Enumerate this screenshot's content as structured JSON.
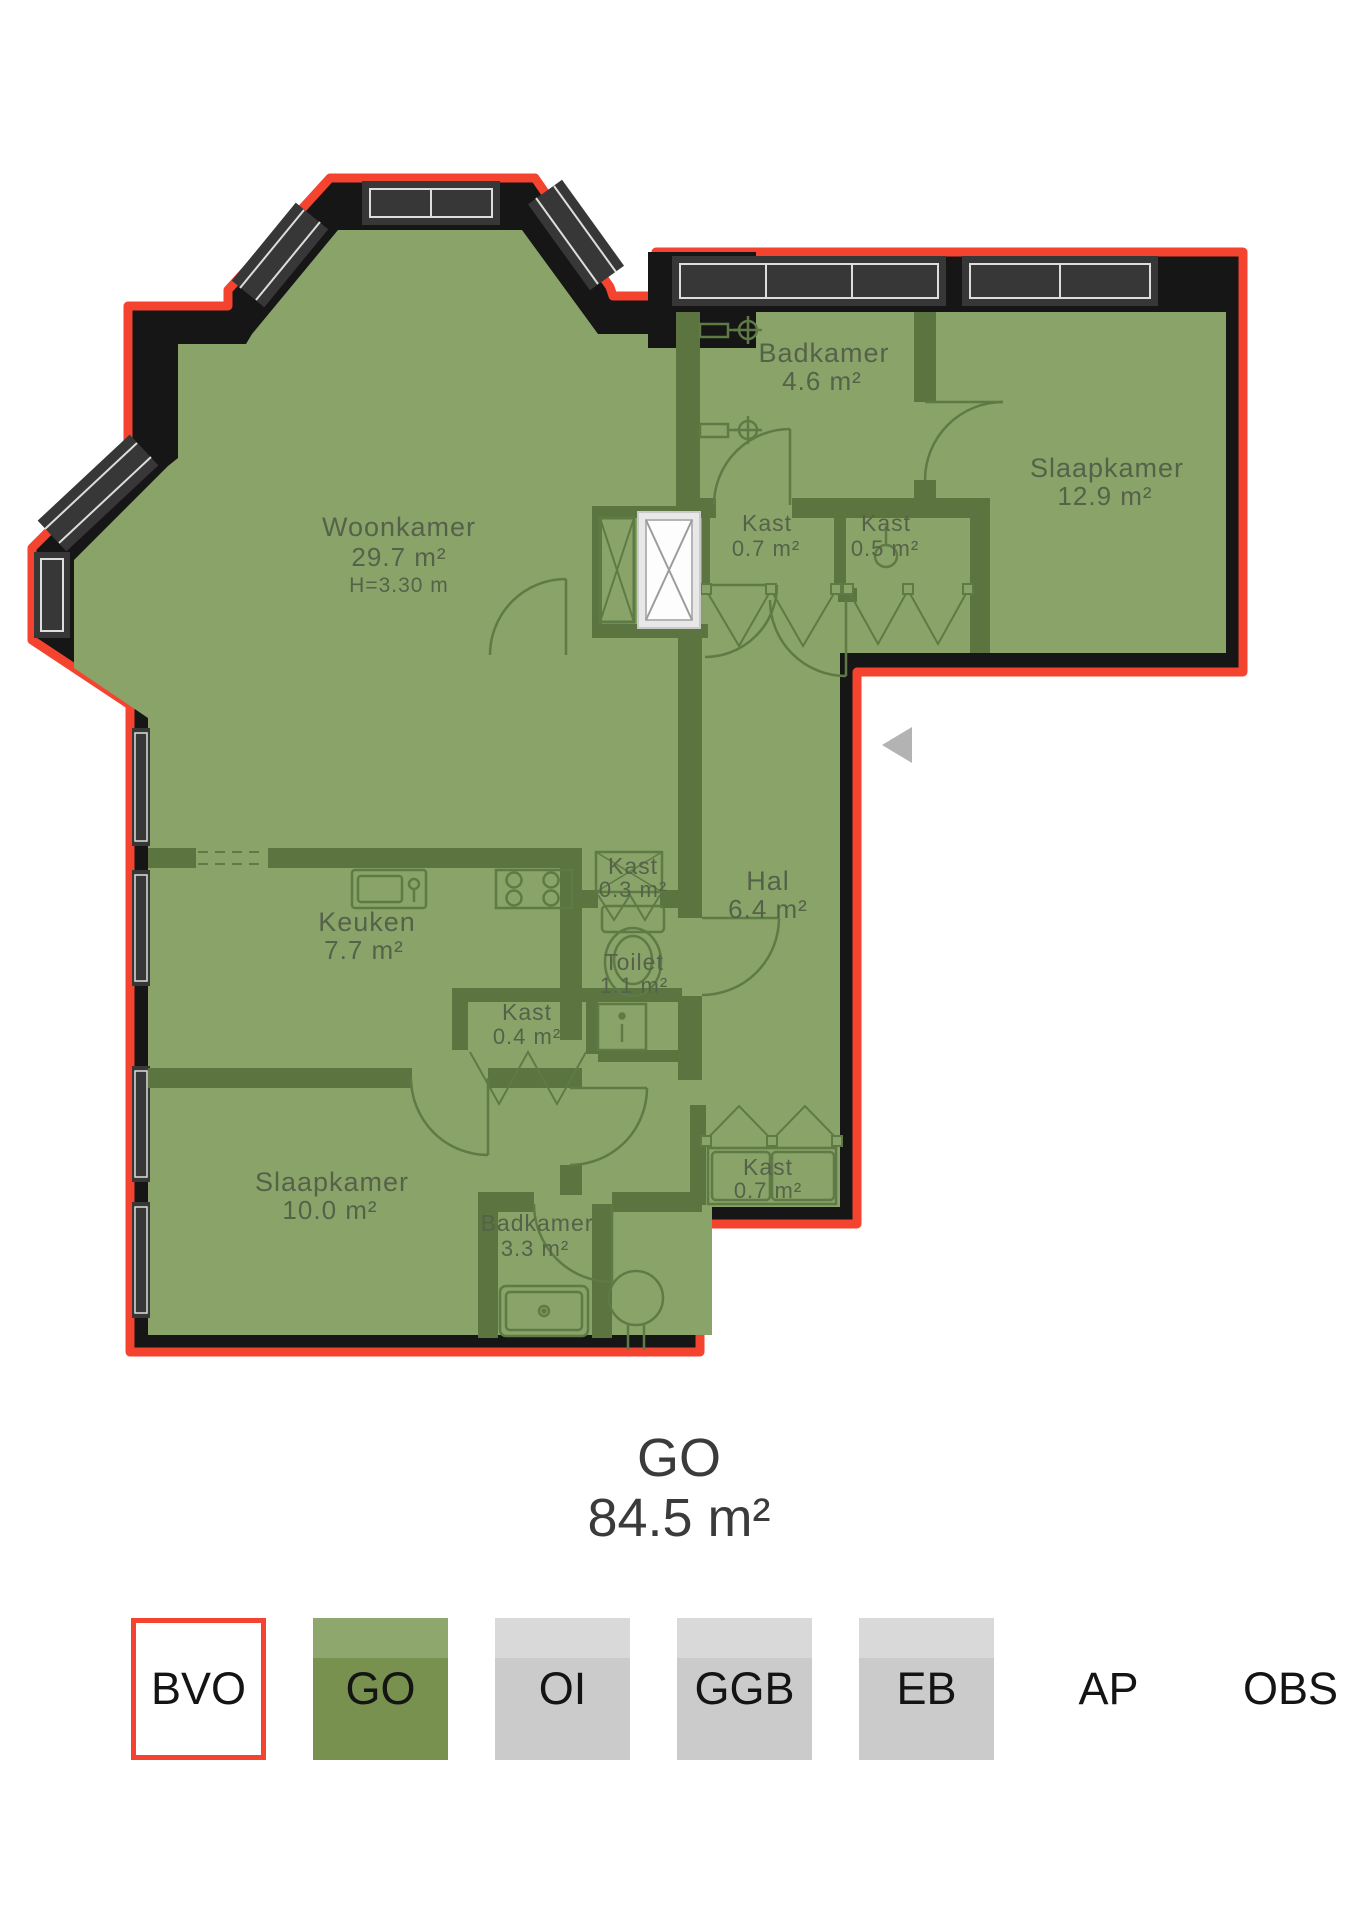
{
  "plan": {
    "rooms": {
      "woonkamer": {
        "name": "Woonkamer",
        "area": "29.7 m²",
        "height": "H=3.30 m"
      },
      "badkamer_top": {
        "name": "Badkamer",
        "area": "4.6 m²"
      },
      "slaapkamer_right": {
        "name": "Slaapkamer",
        "area": "12.9 m²"
      },
      "kast_top_left": {
        "name": "Kast",
        "area": "0.7 m²"
      },
      "kast_top_right": {
        "name": "Kast",
        "area": "0.5 m²"
      },
      "keuken": {
        "name": "Keuken",
        "area": "7.7 m²"
      },
      "kast_mid": {
        "name": "Kast",
        "area": "0.3 m²"
      },
      "hal": {
        "name": "Hal",
        "area": "6.4 m²"
      },
      "toilet": {
        "name": "Toilet",
        "area": "1.1 m²"
      },
      "kast_small": {
        "name": "Kast",
        "area": "0.4 m²"
      },
      "slaapkamer_bottom": {
        "name": "Slaapkamer",
        "area": "10.0 m²"
      },
      "badkamer_bottom": {
        "name": "Badkamer",
        "area": "3.3 m²"
      },
      "kast_bottom": {
        "name": "Kast",
        "area": "0.7 m²"
      }
    },
    "colors": {
      "outline_red": "#f4432e",
      "wall_black": "#161616",
      "floor_green": "#8aa369",
      "interior_wall_olive": "#5c7540",
      "fixture_line": "#5e7a45",
      "label_text": "#55624a"
    }
  },
  "summary": {
    "label": "GO",
    "value": "84.5 m²"
  },
  "legend": {
    "items": [
      {
        "label": "BVO",
        "swatch": {
          "top": "#ffffff",
          "bottom": "#ffffff",
          "border": "#f4432e"
        }
      },
      {
        "label": "GO",
        "swatch": {
          "top": "#8ea76d",
          "bottom": "#78914f"
        }
      },
      {
        "label": "OI",
        "swatch": {
          "top": "#d9d9d9",
          "bottom": "#cbcbcb"
        }
      },
      {
        "label": "GGB",
        "swatch": {
          "top": "#d9d9d9",
          "bottom": "#cbcbcb"
        }
      },
      {
        "label": "EB",
        "swatch": {
          "top": "#d9d9d9",
          "bottom": "#cbcbcb"
        }
      },
      {
        "label": "AP",
        "swatch": null
      },
      {
        "label": "OBS",
        "swatch": null
      }
    ]
  }
}
